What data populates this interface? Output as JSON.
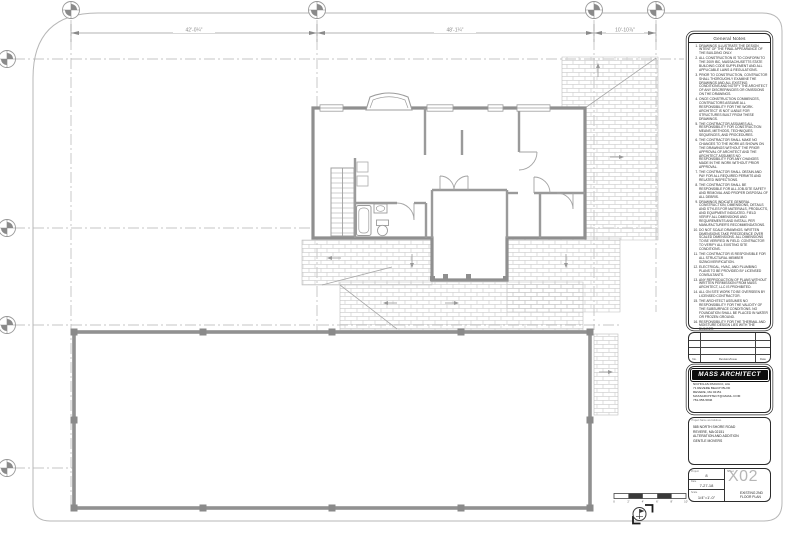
{
  "sheet": {
    "dimensions": [
      "42'-0¼\"",
      "48'-1¼\"",
      "10'-10⅞\""
    ],
    "scale_bar_labels": [
      "0",
      "2'",
      "4'",
      "6'",
      "8'",
      "10'"
    ]
  },
  "notes": {
    "title": "General Notes",
    "items": [
      "DRAWINGS ILLUSTRATE THE DESIGN INTENT OF THE FINAL APPEARANCE OF THE BUILDING ONLY.",
      "ALL CONSTRUCTION IS TO CONFORM TO THE 2009 IBC, MASSACHUSETTS STATE BUILDING CODE SUPPLEMENT AND ALL APPLICABLE LAWS & REGULATIONS.",
      "PRIOR TO CONSTRUCTION, CONTRACTOR SHALL THOROUGHLY EXAMINE THE DRAWINGS AND ALL EXISTING CONDITIONS AND NOTIFY THE ARCHITECT OF ANY DISCREPANCIES OR OMISSIONS ON THE DRAWINGS.",
      "ONCE CONSTRUCTION COMMENCES, CONTRACTORS ASSUME ALL RESPONSIBILITY FOR THE WORK. ARCHITECT IS NOT LIABLE FOR STRUCTURES BUILT FROM THESE DRAWINGS.",
      "THE CONTRACTOR ASSUMES ALL RESPONSIBILITY FOR CONSTRUCTION MEANS, METHODS, TECHNIQUES, SEQUENCES, AND PROCEDURES.",
      "THE CONTRACTOR SHALL MAKE NO CHANGES TO THE WORK AS SHOWN ON THE DRAWINGS WITHOUT THE PRIOR APPROVAL OF ARCHITECT AND THE ARCHITECT ASSUMES NO RESPONSIBILITY FOR ANY CHANGES MADE IN THE WORK WITHOUT PRIOR APPROVAL.",
      "THE CONTRACTOR SHALL OBTAIN AND PAY FOR ALL REQUIRED PERMITS AND RELATED INSPECTIONS.",
      "THE CONTRACTOR SHALL BE RESPONSIBLE FOR ALL JOB-SITE SAFETY AND REMOVAL AND PROPER DISPOSAL OF ALL DEBRIS.",
      "DRAWINGS INDICATE GENERAL CONSTRUCTION, DIMENSIONS, DETAILS AND STYLES FOR MATERIALS, PRODUCTS, AND EQUIPMENT INDICATED. FIELD VERIFY ALL DIMENSIONS AND REQUIREMENTS AND INSTALL PER MANUFACTURER'S RECOMMENDATIONS.",
      "DO NOT SCALE DRAWINGS. WRITTEN DIMENSIONS TAKE PRECEDENCE OVER SCALED DIMENSIONS. ALL DIMENSIONS TO BE VERIFIED IN FIELD. CONTRACTOR TO VERIFY ALL EXISTING SITE CONDITIONS.",
      "THE CONTRACTOR IS RESPONSIBLE FOR ALL STRUCTURAL MEMBER SIZING/VERIFICATION.",
      "ELECTRICAL, HVAC, AND PLUMBING PLANS TO BE PROVIDED BY LICENSED CONSULTANTS.",
      "ANY REPRODUCTION OF PLANS WITHOUT WRITTEN PERMISSION FROM MASS ARCHITECT, LLC IS PROHIBITED.",
      "ALL ON SITE WORK TO BE OVERSEEN BY LICENSED CONTRACTOR.",
      "THE ARCHITECT ASSUMES NO RESPONSIBILITY FOR THE VALIDITY OF THE SUBSURFACE CONDITIONS. NO FOUNDATION SHALL BE PLACED IN WATER OR FROZEN GROUND.",
      "RESPONSIBILITY FOR THE THERMAL AND MOISTURE DESIGN LIES WITH THE BUILDER."
    ]
  },
  "revisions": {
    "no_header": "No.",
    "description_header": "Revision/Issue",
    "date_header": "Date"
  },
  "architect": {
    "firm": "MASS ARCHITECT",
    "name": "NICHOLAS PADUCCI, AIA",
    "address1": "71 REVERE BEACH BLVD",
    "address2": "REVERE, MA 02151",
    "email": "MASSARCHITECT@GMAIL.COM",
    "phone": "781-656-5846"
  },
  "project": {
    "label": "Project Name and Address",
    "line1": "585 NORTH SHORE ROAD",
    "line2": "REVERE, MA 02151",
    "line3": "ALTERATION AND ADDITION",
    "line4": "GENTLE MOVERS"
  },
  "titleblock": {
    "project_label": "Project",
    "project_value": "8",
    "date_label": "Date",
    "date_value": "7-27-18",
    "scale_label": "Scale",
    "scale_value": "1/4\"=1'-0\"",
    "sheet_label": "Sheet",
    "sheet_number": "X02",
    "sheet_title_line1": "EXISTING 2ND",
    "sheet_title_line2": "FLOOR PLAN"
  }
}
